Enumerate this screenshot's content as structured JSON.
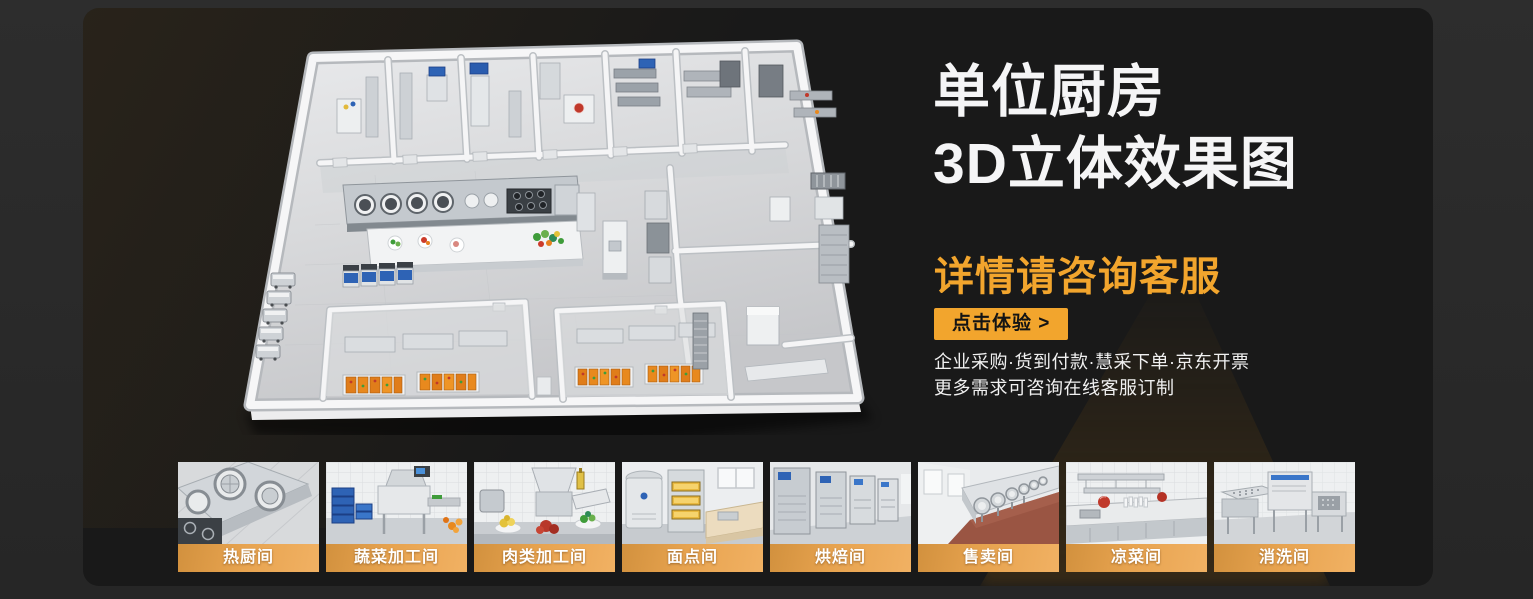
{
  "banner": {
    "title_line1": "单位厨房",
    "title_line2": "3D立体效果图",
    "subtitle": "详情请咨询客服",
    "cta_label": "点击体验 >",
    "feature_line1": "企业采购·货到付款·慧采下单·京东开票",
    "feature_line2": "更多需求可咨询在线客服订制"
  },
  "colors": {
    "accent_orange": "#F2A52D",
    "label_bar_orange": "#E7A34F",
    "panel_background": "#191919",
    "outer_background": "#2B2B2B",
    "title_text": "#F5F5F6"
  },
  "thumbnails": [
    {
      "label": "热厨间"
    },
    {
      "label": "蔬菜加工间"
    },
    {
      "label": "肉类加工间"
    },
    {
      "label": "面点间"
    },
    {
      "label": "烘焙间"
    },
    {
      "label": "售卖间"
    },
    {
      "label": "凉菜间"
    },
    {
      "label": "消洗间"
    }
  ]
}
